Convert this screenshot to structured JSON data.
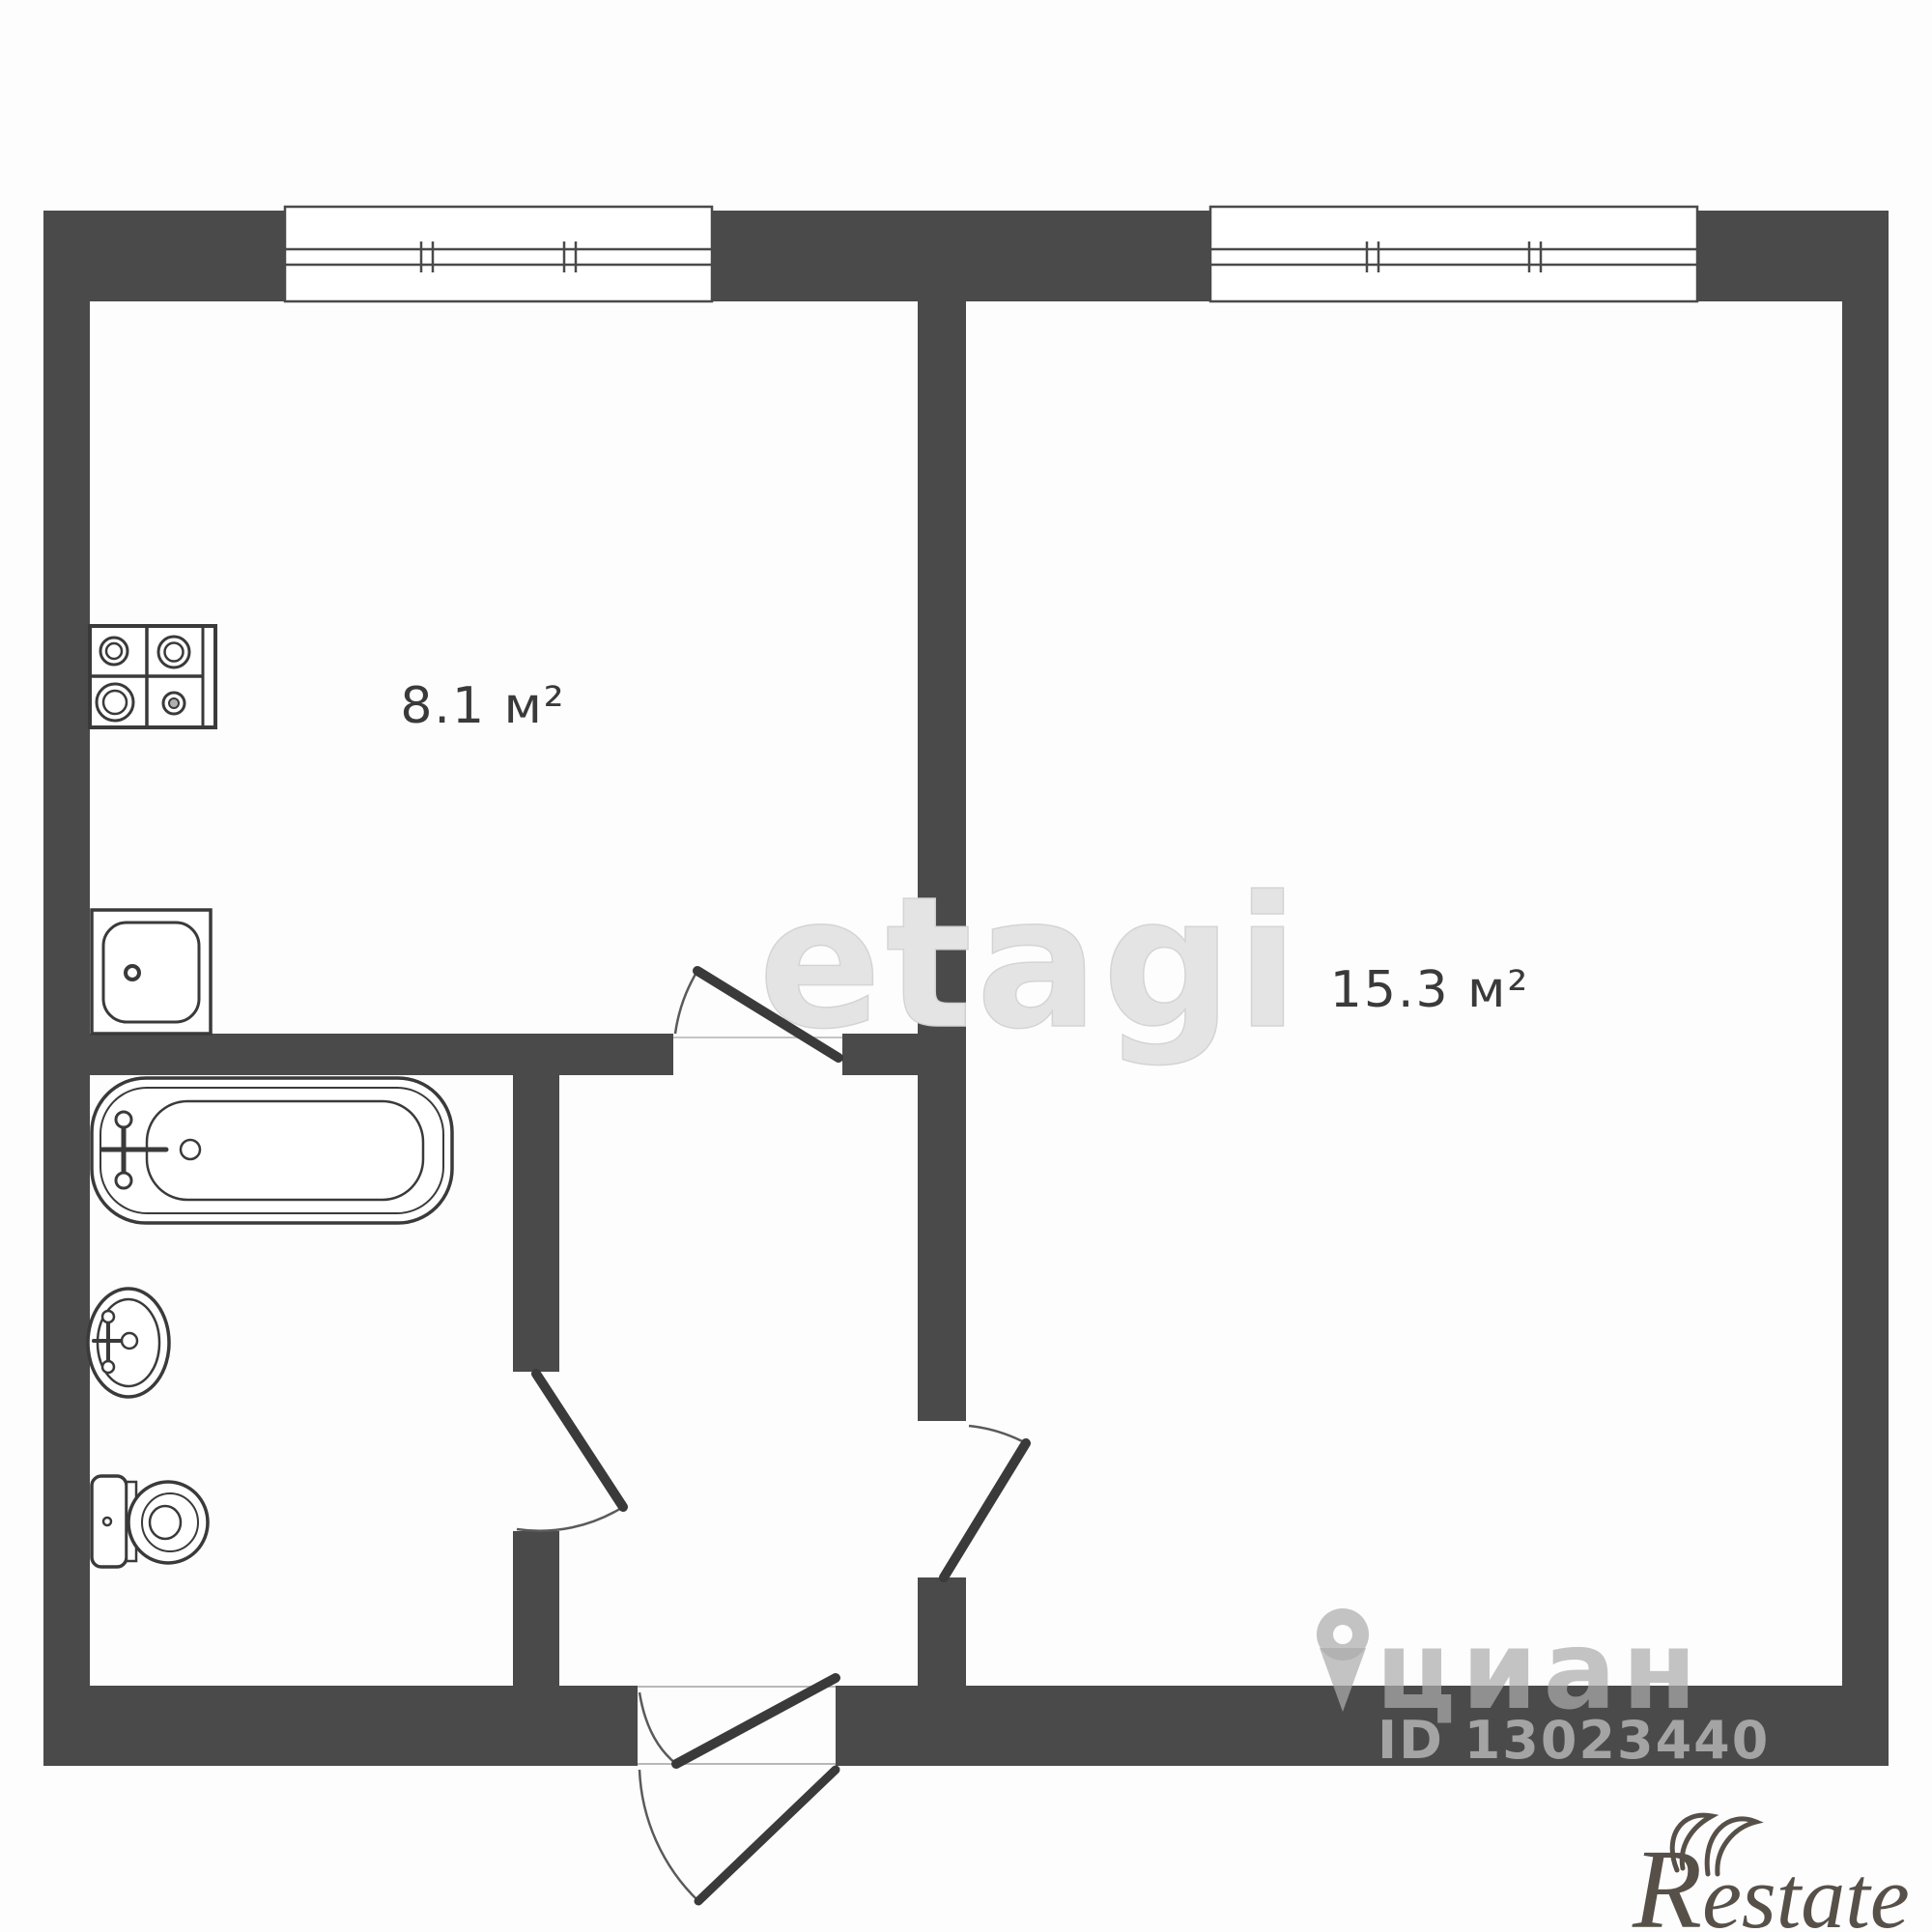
{
  "floor_plan": {
    "type": "apartment-floor-plan",
    "wall_color": "#4a4a4a",
    "line_color": "#3a3a3a",
    "rooms": [
      {
        "id": "kitchen",
        "area_label": "8.1 м²"
      },
      {
        "id": "living-room",
        "area_label": "15.3 м²"
      }
    ],
    "windows_count": 2,
    "doors_count": 4,
    "fixtures": [
      "stove",
      "kitchen-sink",
      "bathtub",
      "washbasin",
      "toilet"
    ]
  },
  "watermarks": {
    "agency": "etagi",
    "listing_site": "циан",
    "listing_id": "ID 13023440",
    "logo_initial": "R",
    "logo_rest": "estate"
  }
}
